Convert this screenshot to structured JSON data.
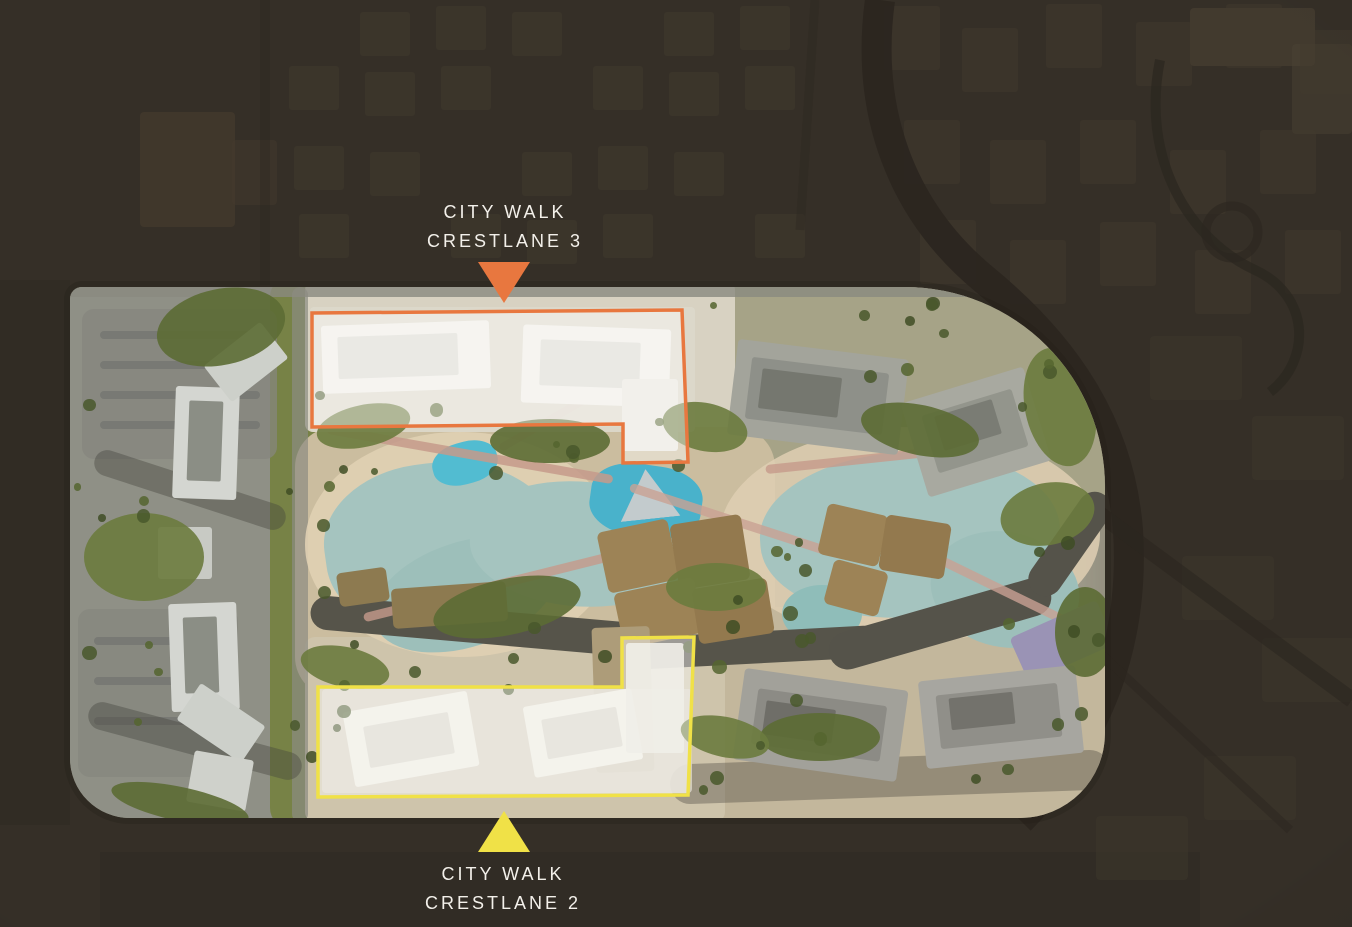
{
  "map": {
    "type": "masterplan-aerial-render",
    "markers": {
      "crestlane3": {
        "lines": [
          "CITY WALK",
          "CRESTLANE 3"
        ],
        "color": "#E8773F",
        "pointer": "down"
      },
      "crestlane2": {
        "lines": [
          "CITY WALK",
          "CRESTLANE 2"
        ],
        "color": "#F0E147",
        "pointer": "up"
      }
    },
    "label_text_color": "#F3F0EA"
  },
  "palette": {
    "background": "#352F27",
    "site_ground": "#ABA795",
    "water": "#A5C4BF",
    "water_deep": "#9DBFBA",
    "pool_blue": "#52BCD1",
    "greenery": "#6B7B3E",
    "greenery_dark": "#5C6C34",
    "path_sand": "#D8C8AC",
    "path_pink": "#C59A8B",
    "road_dark": "#56544A",
    "roof_brown": "#9D8356",
    "building_light": "#D4D6D1",
    "building_white": "#EFEDE6",
    "region_fill": "rgba(255,255,255,0.42)"
  }
}
